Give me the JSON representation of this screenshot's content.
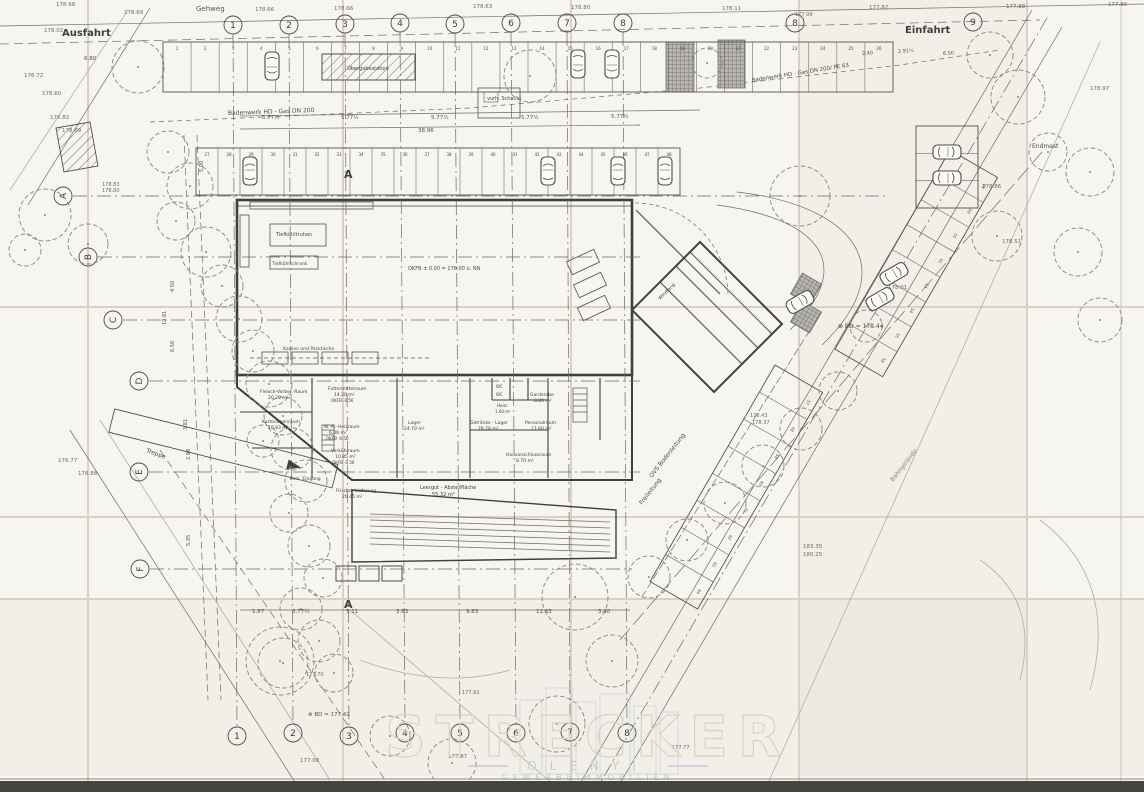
{
  "meta": {
    "drawing_type": "Lageplan / Grundriss (gescannter Bauplan)"
  },
  "colors": {
    "paper": "#f7f5f0",
    "ink": "#3f3f3c",
    "faint": "#9a968c",
    "scanner_band": "#45443f",
    "watermark_tan": "#d9d2c0",
    "watermark_blue": "#b8c9d4"
  },
  "watermark": {
    "line1": "STRECKER",
    "line2": "OLENYI",
    "line3": "GEWERBEIMMOBILIEN"
  },
  "axes": {
    "top": [
      {
        "n": "1",
        "x": 233,
        "y": 25
      },
      {
        "n": "2",
        "x": 289,
        "y": 25
      },
      {
        "n": "3",
        "x": 345,
        "y": 24
      },
      {
        "n": "4",
        "x": 400,
        "y": 23
      },
      {
        "n": "5",
        "x": 455,
        "y": 24
      },
      {
        "n": "6",
        "x": 511,
        "y": 23
      },
      {
        "n": "7",
        "x": 567,
        "y": 23
      },
      {
        "n": "8",
        "x": 623,
        "y": 23
      },
      {
        "n": "8",
        "x": 795,
        "y": 23
      },
      {
        "n": "9",
        "x": 973,
        "y": 22
      }
    ],
    "bottom": [
      {
        "n": "1",
        "x": 237,
        "y": 736
      },
      {
        "n": "2",
        "x": 293,
        "y": 733
      },
      {
        "n": "3",
        "x": 349,
        "y": 736
      },
      {
        "n": "4",
        "x": 405,
        "y": 733
      },
      {
        "n": "5",
        "x": 460,
        "y": 733
      },
      {
        "n": "6",
        "x": 516,
        "y": 733
      },
      {
        "n": "7",
        "x": 570,
        "y": 732
      },
      {
        "n": "8",
        "x": 627,
        "y": 733
      }
    ],
    "left": [
      {
        "n": "A",
        "x": 63,
        "y": 196,
        "lx": 885
      },
      {
        "n": "B",
        "x": 88,
        "y": 257,
        "lx": 640
      },
      {
        "n": "C",
        "x": 113,
        "y": 320,
        "lx": 640
      },
      {
        "n": "D",
        "x": 139,
        "y": 381,
        "lx": 640
      },
      {
        "n": "E",
        "x": 139,
        "y": 472,
        "lx": 640
      },
      {
        "n": "F",
        "x": 140,
        "y": 569,
        "lx": 632
      }
    ]
  },
  "parking": {
    "rows": [
      {
        "x": 163,
        "y": 42,
        "rot": 0,
        "len": 730,
        "depth": 50,
        "dy": 0,
        "n": 26,
        "numStart": 1,
        "numY": 8
      },
      {
        "x": 196,
        "y": 148,
        "rot": 0,
        "len": 484,
        "depth": 47,
        "dy": 0,
        "n": 22,
        "numStart": 27,
        "numY": 8
      },
      {
        "x": 950,
        "y": 150,
        "rot": 120,
        "len": 230,
        "depth": 55,
        "dy": -55,
        "n": 8,
        "numStart": 49,
        "numY": -46
      },
      {
        "x": 775,
        "y": 365,
        "rot": 120,
        "len": 250,
        "depth": 55,
        "dy": -55,
        "n": 8,
        "numStart": 57,
        "numY": -46
      },
      {
        "x": 978,
        "y": 126,
        "rot": 90,
        "len": 82,
        "depth": 62,
        "dy": 0,
        "n": 3,
        "numStart": null,
        "numY": 8
      }
    ]
  },
  "cars": [
    [
      272,
      66,
      180
    ],
    [
      578,
      64,
      180
    ],
    [
      612,
      64,
      180
    ],
    [
      250,
      171,
      0
    ],
    [
      548,
      171,
      0
    ],
    [
      618,
      171,
      0
    ],
    [
      665,
      171,
      0
    ],
    [
      894,
      274,
      60
    ],
    [
      880,
      299,
      60
    ],
    [
      800,
      302,
      60
    ],
    [
      947,
      152,
      90
    ],
    [
      947,
      178,
      90
    ]
  ],
  "trees": [
    [
      138,
      67,
      26
    ],
    [
      530,
      76,
      26
    ],
    [
      707,
      63,
      15
    ],
    [
      45,
      215,
      26
    ],
    [
      88,
      244,
      20
    ],
    [
      25,
      250,
      16
    ],
    [
      168,
      152,
      21
    ],
    [
      190,
      186,
      23
    ],
    [
      176,
      221,
      19
    ],
    [
      206,
      252,
      25
    ],
    [
      222,
      286,
      21
    ],
    [
      239,
      319,
      23
    ],
    [
      253,
      351,
      21
    ],
    [
      269,
      384,
      23
    ],
    [
      283,
      416,
      19
    ],
    [
      263,
      441,
      16
    ],
    [
      292,
      449,
      21
    ],
    [
      306,
      481,
      21
    ],
    [
      289,
      513,
      19
    ],
    [
      309,
      546,
      21
    ],
    [
      323,
      578,
      19
    ],
    [
      301,
      609,
      21
    ],
    [
      319,
      641,
      21
    ],
    [
      283,
      663,
      25
    ],
    [
      334,
      673,
      19
    ],
    [
      990,
      55,
      23
    ],
    [
      1018,
      97,
      27
    ],
    [
      997,
      236,
      25
    ],
    [
      1048,
      152,
      19
    ],
    [
      1090,
      172,
      24
    ],
    [
      1078,
      252,
      24
    ],
    [
      1100,
      320,
      22
    ],
    [
      866,
      326,
      16
    ],
    [
      800,
      196,
      30
    ],
    [
      838,
      391,
      19
    ],
    [
      801,
      429,
      21
    ],
    [
      763,
      466,
      21
    ],
    [
      725,
      503,
      21
    ],
    [
      687,
      540,
      21
    ],
    [
      649,
      577,
      21
    ],
    [
      575,
      597,
      33
    ],
    [
      612,
      661,
      26
    ],
    [
      557,
      724,
      28
    ],
    [
      452,
      763,
      24
    ],
    [
      390,
      736,
      20
    ],
    [
      280,
      661,
      34
    ]
  ],
  "annotations": [
    {
      "t": "Gehweg",
      "x": 196,
      "y": 11,
      "s": 7,
      "c": "#5c5952"
    },
    {
      "t": "Ausfahrt",
      "x": 62,
      "y": 36,
      "s": 10,
      "b": 1
    },
    {
      "t": "Einfahrt",
      "x": 905,
      "y": 33,
      "s": 10,
      "b": 1
    },
    {
      "t": "178.68",
      "x": 56,
      "y": 6,
      "s": 5.5,
      "c": "#6e6a62"
    },
    {
      "t": "178.69",
      "x": 124,
      "y": 14,
      "s": 5.5,
      "c": "#6e6a62"
    },
    {
      "t": "178.66",
      "x": 255,
      "y": 11,
      "s": 5.5,
      "c": "#6e6a62"
    },
    {
      "t": "178.66",
      "x": 334,
      "y": 10,
      "s": 5.5,
      "c": "#6e6a62"
    },
    {
      "t": "178.63",
      "x": 473,
      "y": 8,
      "s": 5.5,
      "c": "#6e6a62"
    },
    {
      "t": "178.80",
      "x": 571,
      "y": 9,
      "s": 5.5,
      "c": "#6e6a62"
    },
    {
      "t": "178.11",
      "x": 722,
      "y": 10,
      "s": 5.5,
      "c": "#6e6a62"
    },
    {
      "t": "177.87",
      "x": 869,
      "y": 9,
      "s": 5.5,
      "c": "#6e6a62"
    },
    {
      "t": "177.99",
      "x": 795,
      "y": 16,
      "s": 5,
      "c": "#6e6a62"
    },
    {
      "t": "177.88",
      "x": 1006,
      "y": 8,
      "s": 5.5,
      "c": "#6e6a62"
    },
    {
      "t": "177.86",
      "x": 1108,
      "y": 6,
      "s": 5.5,
      "c": "#6e6a62"
    },
    {
      "t": "178.02",
      "x": 44,
      "y": 32,
      "s": 5.5,
      "c": "#6e6a62"
    },
    {
      "t": "176.72",
      "x": 24,
      "y": 77,
      "s": 5.5,
      "c": "#6e6a62"
    },
    {
      "t": "178.60",
      "x": 42,
      "y": 95,
      "s": 5.5,
      "c": "#6e6a62"
    },
    {
      "t": "176.82",
      "x": 50,
      "y": 119,
      "s": 5.5,
      "c": "#6e6a62"
    },
    {
      "t": "178.89",
      "x": 62,
      "y": 132,
      "s": 5.5,
      "c": "#6e6a62"
    },
    {
      "t": "178.83",
      "x": 102,
      "y": 186,
      "s": 5,
      "c": "#6e6a62"
    },
    {
      "t": "178.80",
      "x": 102,
      "y": 192,
      "s": 5,
      "c": "#6e6a62"
    },
    {
      "t": "176.77",
      "x": 58,
      "y": 462,
      "s": 5.5,
      "c": "#6e6a62"
    },
    {
      "t": "176.88",
      "x": 78,
      "y": 475,
      "s": 5.5,
      "c": "#6e6a62"
    },
    {
      "t": "178.97",
      "x": 1090,
      "y": 90,
      "s": 5.5,
      "c": "#6e6a62"
    },
    {
      "t": "178.01",
      "x": 888,
      "y": 289,
      "s": 5.5,
      "c": "#6e6a62"
    },
    {
      "t": "178.86",
      "x": 982,
      "y": 188,
      "s": 5.5,
      "c": "#6e6a62"
    },
    {
      "t": "178.51",
      "x": 1002,
      "y": 243,
      "s": 5.5,
      "c": "#6e6a62"
    },
    {
      "t": "178.43",
      "x": 750,
      "y": 417,
      "s": 5,
      "c": "#6e6a62"
    },
    {
      "t": "178.37",
      "x": 752,
      "y": 424,
      "s": 5,
      "c": "#6e6a62"
    },
    {
      "t": "183.35",
      "x": 803,
      "y": 548,
      "s": 5.5,
      "c": "#6e6a62"
    },
    {
      "t": "180.25",
      "x": 803,
      "y": 556,
      "s": 5.5,
      "c": "#6e6a62"
    },
    {
      "t": "177.70",
      "x": 306,
      "y": 676,
      "s": 5,
      "c": "#6e6a62"
    },
    {
      "t": "177.08",
      "x": 300,
      "y": 762,
      "s": 5.5,
      "c": "#6e6a62"
    },
    {
      "t": "177.92",
      "x": 462,
      "y": 694,
      "s": 5,
      "c": "#6e6a62"
    },
    {
      "t": "177.87",
      "x": 448,
      "y": 758,
      "s": 5.5,
      "c": "#6e6a62"
    },
    {
      "t": "177.77",
      "x": 672,
      "y": 749,
      "s": 5,
      "c": "#6e6a62"
    },
    {
      "t": "vorh. Schacht",
      "x": 487,
      "y": 100,
      "s": 5,
      "c": "#4c4a44"
    },
    {
      "t": "Badenwerk HD - Gas DN 200",
      "x": 228,
      "y": 115,
      "s": 6,
      "r": -2,
      "c": "#4c4a44"
    },
    {
      "t": "Badenwerk HD - Gas DN 200/ PE 63",
      "x": 752,
      "y": 82,
      "s": 5.5,
      "r": -9,
      "c": "#4c4a44"
    },
    {
      "t": "⊗ BD = 178.44",
      "x": 838,
      "y": 328,
      "s": 6,
      "c": "#4c4a44"
    },
    {
      "t": "⊗ BD = 177.42",
      "x": 308,
      "y": 716,
      "s": 5.5,
      "c": "#55524b"
    },
    {
      "t": "Endmast",
      "x": 1032,
      "y": 148,
      "s": 6,
      "c": "#4c4a44"
    },
    {
      "t": "OVS  Bodenleitung",
      "x": 652,
      "y": 478,
      "s": 6,
      "r": -52,
      "c": "#4c4a44"
    },
    {
      "t": "Freileitung",
      "x": 642,
      "y": 505,
      "s": 6,
      "r": -52,
      "c": "#4c4a44"
    },
    {
      "t": "Bahngelände",
      "x": 893,
      "y": 482,
      "s": 6,
      "r": -52,
      "c": "#8a867c"
    },
    {
      "t": "Treppe",
      "x": 146,
      "y": 452,
      "s": 6,
      "r": 20,
      "c": "#4c4a44"
    },
    {
      "t": "A",
      "x": 344,
      "y": 178,
      "s": 11,
      "b": 1
    },
    {
      "t": "A",
      "x": 344,
      "y": 608,
      "s": 11,
      "b": 1
    },
    {
      "t": "Übergabestation",
      "x": 368,
      "y": 70,
      "s": 5,
      "c": "#3f3f3c",
      "a": "middle"
    },
    {
      "t": "6.80",
      "x": 84,
      "y": 60,
      "s": 5.5,
      "c": "#55524b"
    },
    {
      "t": "5.77½",
      "x": 262,
      "y": 119,
      "s": 5.5,
      "c": "#55524b"
    },
    {
      "t": "5.77½",
      "x": 341,
      "y": 119,
      "s": 5.5,
      "c": "#55524b"
    },
    {
      "t": "5.77½",
      "x": 431,
      "y": 119,
      "s": 5.5,
      "c": "#55524b"
    },
    {
      "t": "5.77½",
      "x": 521,
      "y": 119,
      "s": 5.5,
      "c": "#55524b"
    },
    {
      "t": "5.77½",
      "x": 611,
      "y": 118,
      "s": 5.5,
      "c": "#55524b"
    },
    {
      "t": "38.96",
      "x": 418,
      "y": 132,
      "s": 5.5,
      "c": "#55524b"
    },
    {
      "t": "2.40",
      "x": 862,
      "y": 55,
      "s": 5,
      "r": -4,
      "c": "#55524b"
    },
    {
      "t": "2.91½",
      "x": 898,
      "y": 53,
      "s": 5,
      "r": -4,
      "c": "#55524b"
    },
    {
      "t": "6.50",
      "x": 943,
      "y": 55,
      "s": 5,
      "r": -4,
      "c": "#55524b"
    },
    {
      "t": "Tiefkühltruhen",
      "x": 276,
      "y": 236,
      "s": 5,
      "c": "#4c4a44"
    },
    {
      "t": "Tiefkühlschrank",
      "x": 272,
      "y": 265,
      "s": 4.5,
      "c": "#4c4a44"
    },
    {
      "t": "OKFB ± 0.00 = 178.00 ü. NN",
      "x": 408,
      "y": 270,
      "s": 5,
      "c": "#4c4a44"
    },
    {
      "t": "Kassen und Packtische",
      "x": 283,
      "y": 350,
      "s": 4.5,
      "c": "#4c4a44"
    },
    {
      "t": "Fleisch-Vorber.-Raum",
      "x": 260,
      "y": 393,
      "s": 4.5
    },
    {
      "t": "20.20 m²",
      "x": 268,
      "y": 399,
      "s": 4.5
    },
    {
      "t": "Kartonagenraum",
      "x": 262,
      "y": 423,
      "s": 4.5
    },
    {
      "t": "10.83 m²",
      "x": 268,
      "y": 429,
      "s": 4.5
    },
    {
      "t": "Futtermittelraum",
      "x": 328,
      "y": 390,
      "s": 4.5
    },
    {
      "t": "14.20 m²",
      "x": 334,
      "y": 396,
      "s": 4.5
    },
    {
      "t": "OKFB -0.56",
      "x": 331,
      "y": 402,
      "s": 4
    },
    {
      "t": "W.-M.-Heizraum",
      "x": 324,
      "y": 428,
      "s": 4.5
    },
    {
      "t": "6.06 m²",
      "x": 329,
      "y": 434,
      "s": 4.5
    },
    {
      "t": "OKFB -0.56",
      "x": 326,
      "y": 440,
      "s": 4
    },
    {
      "t": "Vorkühlraum",
      "x": 331,
      "y": 452,
      "s": 4.5
    },
    {
      "t": "10.85 m²",
      "x": 335,
      "y": 458,
      "s": 4.5
    },
    {
      "t": "OKFB -0.56",
      "x": 332,
      "y": 464,
      "s": 4
    },
    {
      "t": "Lager",
      "x": 408,
      "y": 424,
      "s": 4.5
    },
    {
      "t": "24.70 m²",
      "x": 404,
      "y": 430,
      "s": 4.5
    },
    {
      "t": "Getränke - Lager",
      "x": 470,
      "y": 424,
      "s": 4.5
    },
    {
      "t": "78.78 m²",
      "x": 478,
      "y": 430,
      "s": 4.5
    },
    {
      "t": "Heizr.",
      "x": 497,
      "y": 407,
      "s": 4
    },
    {
      "t": "1.60 m²",
      "x": 495,
      "y": 413,
      "s": 4
    },
    {
      "t": "Personalraum",
      "x": 525,
      "y": 424,
      "s": 4.5
    },
    {
      "t": "17.60 m²",
      "x": 531,
      "y": 430,
      "s": 4.5
    },
    {
      "t": "Garderobe",
      "x": 530,
      "y": 396,
      "s": 4.5
    },
    {
      "t": "8.80 m²",
      "x": 534,
      "y": 402,
      "s": 4.5
    },
    {
      "t": "Hausanschlussraum",
      "x": 506,
      "y": 456,
      "s": 4.5
    },
    {
      "t": "8.70 m²",
      "x": 516,
      "y": 462,
      "s": 4.5
    },
    {
      "t": "WC",
      "x": 496,
      "y": 388,
      "s": 4
    },
    {
      "t": "WC",
      "x": 496,
      "y": 396,
      "s": 4
    },
    {
      "t": "Pers. Eingang",
      "x": 290,
      "y": 480,
      "s": 4.5
    },
    {
      "t": "Frischd.-Lieferung",
      "x": 336,
      "y": 492,
      "s": 4.5
    },
    {
      "t": "20.45 m²",
      "x": 342,
      "y": 498,
      "s": 4.5
    },
    {
      "t": "Leergut - Abstellfläche",
      "x": 420,
      "y": 489,
      "s": 5
    },
    {
      "t": "55.32 m²",
      "x": 432,
      "y": 496,
      "s": 5
    },
    {
      "t": "Windfang",
      "x": 660,
      "y": 300,
      "s": 4.5,
      "r": -45
    },
    {
      "t": "1.87",
      "x": 252,
      "y": 613,
      "s": 5.5,
      "c": "#55524b"
    },
    {
      "t": "3.77½",
      "x": 292,
      "y": 613,
      "s": 5.5,
      "c": "#55524b"
    },
    {
      "t": "5.11",
      "x": 346,
      "y": 613,
      "s": 5.5,
      "c": "#55524b"
    },
    {
      "t": "3.63",
      "x": 396,
      "y": 613,
      "s": 5.5,
      "c": "#55524b"
    },
    {
      "t": "9.63",
      "x": 466,
      "y": 613,
      "s": 5.5,
      "c": "#55524b"
    },
    {
      "t": "11.63",
      "x": 536,
      "y": 613,
      "s": 5.5,
      "c": "#55524b"
    },
    {
      "t": "3.40",
      "x": 598,
      "y": 613,
      "s": 5.5,
      "c": "#55524b"
    },
    {
      "t": "4.50",
      "x": 174,
      "y": 292,
      "s": 5,
      "r": -90,
      "c": "#55524b"
    },
    {
      "t": "19.81",
      "x": 166,
      "y": 325,
      "s": 5,
      "r": -90,
      "c": "#55524b"
    },
    {
      "t": "6.56",
      "x": 174,
      "y": 352,
      "s": 5,
      "r": -90,
      "c": "#55524b"
    },
    {
      "t": "3.81",
      "x": 187,
      "y": 430,
      "s": 5,
      "r": -90,
      "c": "#55524b"
    },
    {
      "t": "2.98",
      "x": 190,
      "y": 460,
      "s": 5,
      "r": -90,
      "c": "#55524b"
    },
    {
      "t": "5.35",
      "x": 190,
      "y": 546,
      "s": 5,
      "r": -90,
      "c": "#55524b"
    },
    {
      "t": "5.00",
      "x": 203,
      "y": 172,
      "s": 5,
      "r": -90,
      "c": "#55524b"
    }
  ]
}
